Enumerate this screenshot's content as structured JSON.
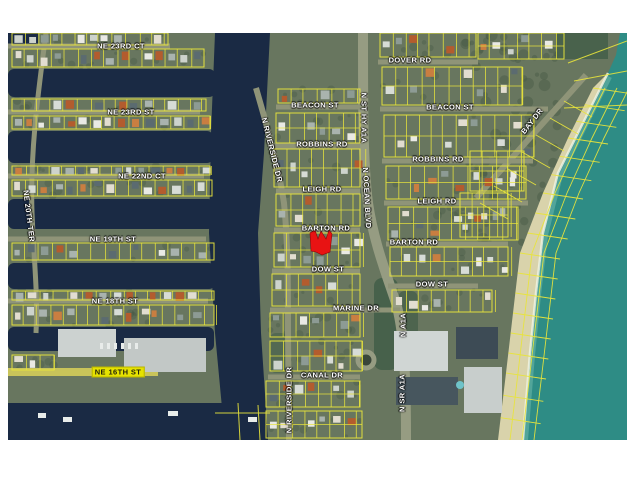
{
  "map": {
    "description": "aerial parcel map with yellow lot boundaries",
    "colors": {
      "parcel_line": "#e8e43c",
      "canal_water": "#1a2a44",
      "ocean": "#2e8c85",
      "beach_sand": "#d9d3ab",
      "land": "#68765f",
      "road": "#8f9478",
      "label_text": "#ffffff",
      "highlight_parcel": "#e81313",
      "highlight_label_bg": "#e6e200"
    },
    "marker": {
      "label": "highlighted-parcel",
      "color": "#e81313",
      "points": "302,200 307,197 310,206 313,198 318,206 321,197 324,201 322,219 314,222 308,219 303,218"
    },
    "labels": [
      {
        "text": "NE 23RD CT",
        "x": 113,
        "y": 13,
        "rot": 0
      },
      {
        "text": "NE 23RD ST",
        "x": 123,
        "y": 79,
        "rot": 0
      },
      {
        "text": "NE 22ND CT",
        "x": 134,
        "y": 143,
        "rot": 0
      },
      {
        "text": "NE 19TH ST",
        "x": 105,
        "y": 206,
        "rot": 0
      },
      {
        "text": "NE 18TH ST",
        "x": 107,
        "y": 268,
        "rot": 0
      },
      {
        "text": "NE 16TH ST",
        "x": 110,
        "y": 339,
        "rot": 0,
        "variant": "highlight"
      },
      {
        "text": "NE 20TH TER",
        "x": 21,
        "y": 183,
        "rot": 83
      },
      {
        "text": "DOVER RD",
        "x": 402,
        "y": 27,
        "rot": 0
      },
      {
        "text": "BEACON ST",
        "x": 307,
        "y": 72,
        "rot": 0
      },
      {
        "text": "BEACON ST",
        "x": 442,
        "y": 74,
        "rot": 0
      },
      {
        "text": "ROBBINS RD",
        "x": 314,
        "y": 111,
        "rot": 0
      },
      {
        "text": "ROBBINS RD",
        "x": 430,
        "y": 126,
        "rot": 0
      },
      {
        "text": "LEIGH RD",
        "x": 314,
        "y": 156,
        "rot": 0
      },
      {
        "text": "LEIGH RD",
        "x": 429,
        "y": 168,
        "rot": 0
      },
      {
        "text": "BARTON RD",
        "x": 318,
        "y": 195,
        "rot": 0
      },
      {
        "text": "BARTON RD",
        "x": 406,
        "y": 209,
        "rot": 0
      },
      {
        "text": "DOW ST",
        "x": 320,
        "y": 236,
        "rot": 0
      },
      {
        "text": "DOW ST",
        "x": 424,
        "y": 251,
        "rot": 0
      },
      {
        "text": "MARINE DR",
        "x": 348,
        "y": 275,
        "rot": 0
      },
      {
        "text": "CANAL DR",
        "x": 314,
        "y": 342,
        "rot": 0
      },
      {
        "text": "N RIVERSIDE DR",
        "x": 264,
        "y": 117,
        "rot": 76
      },
      {
        "text": "N ST HY A1A",
        "x": 356,
        "y": 85,
        "rot": 90
      },
      {
        "text": "N OCEAN BLVD",
        "x": 359,
        "y": 165,
        "rot": 87
      },
      {
        "text": "BAY DR",
        "x": 524,
        "y": 88,
        "rot": -52
      },
      {
        "text": "N RIVERSIDE DR",
        "x": 281,
        "y": 367,
        "rot": -90
      },
      {
        "text": "N A1A",
        "x": 395,
        "y": 292,
        "rot": -90
      },
      {
        "text": "N SR A1A",
        "x": 394,
        "y": 360,
        "rot": -90
      }
    ]
  }
}
